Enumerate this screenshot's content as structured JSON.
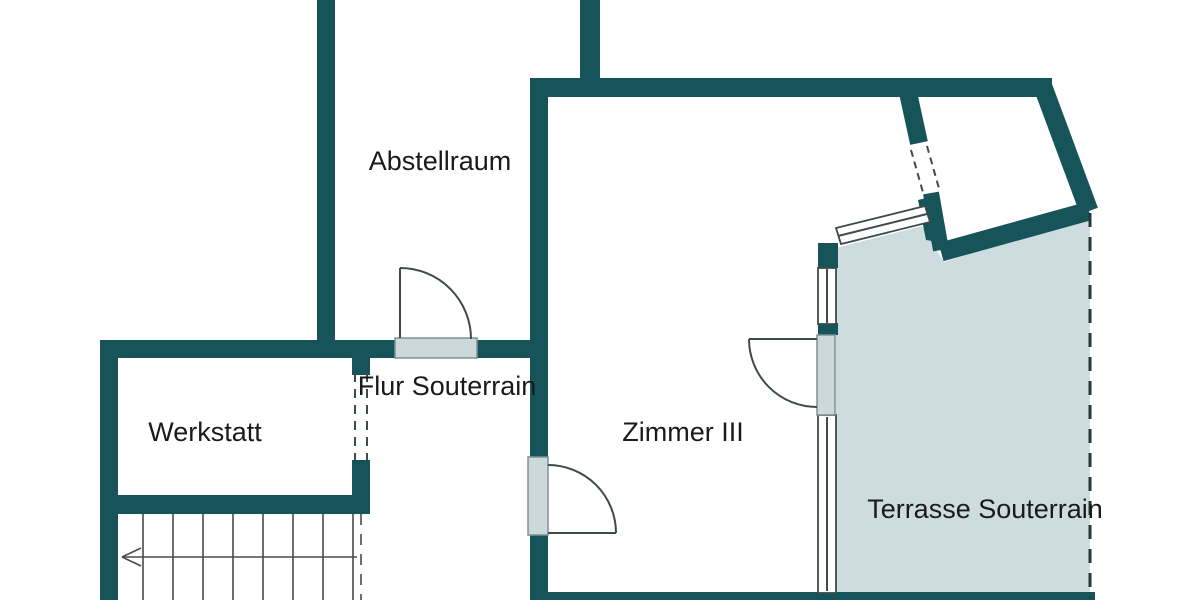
{
  "plan": {
    "floor_name": "Souterrain",
    "rooms": [
      {
        "id": "abstellraum",
        "label": "Abstellraum"
      },
      {
        "id": "flur",
        "label": "Flur Souterrain"
      },
      {
        "id": "werkstatt",
        "label": "Werkstatt"
      },
      {
        "id": "zimmer3",
        "label": "Zimmer III"
      },
      {
        "id": "terrasse",
        "label": "Terrasse Souterrain"
      }
    ],
    "features": {
      "doors": 3,
      "windows": 4,
      "stair_direction": "down-left"
    }
  },
  "colors": {
    "background": "#ffffff",
    "wall": "#175459",
    "terrace_fill": "#cddcdf",
    "door_fill": "#ccd8da",
    "door_stroke": "#7d9296",
    "line": "#3f4a4c",
    "stair_line": "#4a4a4a",
    "dash": "#23393c",
    "text": "#1a1a1a"
  }
}
